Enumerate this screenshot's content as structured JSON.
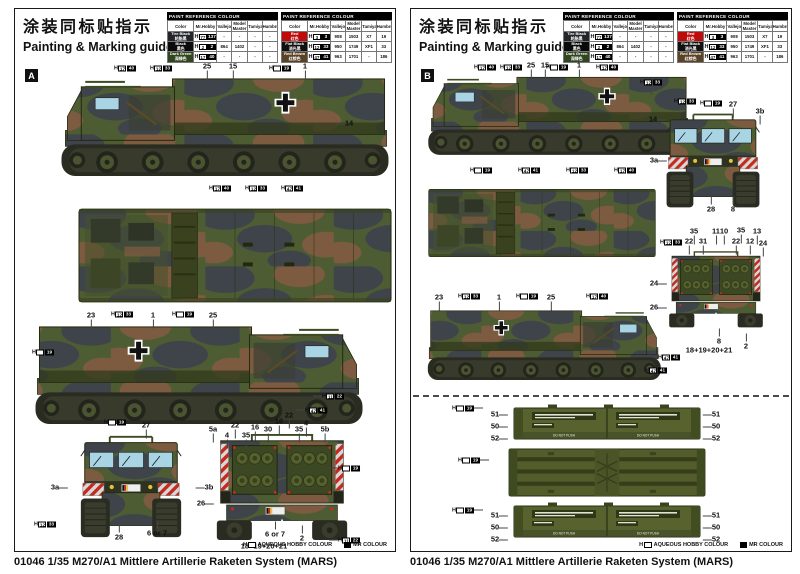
{
  "header": {
    "title_cn": "涂装同标贴指示",
    "title_en": "Painting & Marking guide"
  },
  "paint_table_title": "PAINT REFERENCE COLOUR",
  "paint_columns": [
    "Color",
    "Mr.Hobby",
    "Vallejo",
    "Model Master",
    "Tamiya",
    "Humbrol"
  ],
  "paint_tables": [
    {
      "rows": [
        {
          "name": "Tire Black",
          "name_cn": "轮胎黑",
          "swatch": "#23252a",
          "fg": "#ffffff",
          "chip": {
            "h": "77",
            "c": "137"
          },
          "vallejo": "-",
          "model_master": "-",
          "tamiya": "-",
          "humbrol": "-"
        },
        {
          "name": "Black",
          "name_cn": "黑色",
          "swatch": "#0a0a0a",
          "fg": "#ffffff",
          "chip": {
            "h": "2",
            "c": "2"
          },
          "vallejo": "864",
          "model_master": "1402",
          "tamiya": "-",
          "humbrol": "-"
        },
        {
          "name": "Dark Green",
          "name_cn": "深绿色",
          "swatch": "#31451f",
          "fg": "#ffffff",
          "chip": {
            "h": "17",
            "c": "40"
          },
          "vallejo": "-",
          "model_master": "-",
          "tamiya": "-",
          "humbrol": "-"
        }
      ]
    },
    {
      "rows": [
        {
          "name": "Red",
          "name_cn": "红色",
          "swatch": "#c00a0a",
          "fg": "#ffffff",
          "chip": {
            "h": "3",
            "c": "3"
          },
          "vallejo": "908",
          "model_master": "1503",
          "tamiya": "X7",
          "humbrol": "19"
        },
        {
          "name": "Flat Black",
          "name_cn": "消光黑",
          "swatch": "#101010",
          "fg": "#ffffff",
          "chip": {
            "h": "12",
            "c": "33"
          },
          "vallejo": "950",
          "model_master": "1749",
          "tamiya": "XF1",
          "humbrol": "33"
        },
        {
          "name": "Red Brown",
          "name_cn": "红棕色",
          "swatch": "#5a4227",
          "fg": "#ffffff",
          "chip": {
            "h": "47",
            "c": "41"
          },
          "vallejo": "963",
          "model_master": "1701",
          "tamiya": "-",
          "humbrol": "186"
        }
      ]
    }
  ],
  "legend": {
    "h_label": "AQUEOUS HOBBY COLOUR",
    "mr_label": "MR COLOUR"
  },
  "caption": "01046 1/35 M270/A1 Mittlere Artillerie Raketen System (MARS)",
  "pod_stencil": "DO NOT PUSH",
  "panels": [
    {
      "marker": "A",
      "callouts": [
        {
          "t": "25",
          "x": 192,
          "y": 9,
          "tk": "d"
        },
        {
          "t": "15",
          "x": 218,
          "y": 9,
          "tk": "d"
        },
        {
          "t": "1",
          "x": 290,
          "y": 9,
          "tk": "d"
        },
        {
          "chip": {
            "h": "17",
            "c": "40"
          },
          "x": 110,
          "y": 10
        },
        {
          "chip": {
            "h": "12",
            "c": "33"
          },
          "x": 146,
          "y": 10
        },
        {
          "chip": {
            "h": "",
            "c": "19"
          },
          "x": 265,
          "y": 10
        },
        {
          "t": "14",
          "x": 334,
          "y": 66,
          "tk": "l"
        },
        {
          "chip": {
            "h": "17",
            "c": "40"
          },
          "x": 205,
          "y": 130
        },
        {
          "chip": {
            "h": "12",
            "c": "33"
          },
          "x": 241,
          "y": 130
        },
        {
          "chip": {
            "h": "47",
            "c": "41"
          },
          "x": 277,
          "y": 130
        },
        {
          "t": "23",
          "x": 76,
          "y": 258,
          "tk": "d"
        },
        {
          "chip": {
            "h": "12",
            "c": "33"
          },
          "x": 107,
          "y": 256
        },
        {
          "t": "1",
          "x": 138,
          "y": 258,
          "tk": "d"
        },
        {
          "chip": {
            "h": "",
            "c": "19"
          },
          "x": 168,
          "y": 256
        },
        {
          "t": "25",
          "x": 198,
          "y": 258,
          "tk": "d"
        },
        {
          "chip": {
            "h": "",
            "c": "19"
          },
          "x": 28,
          "y": 294,
          "tk": "r"
        },
        {
          "chip": {
            "h": "11",
            "c": "22"
          },
          "x": 318,
          "y": 338,
          "tk": "l"
        },
        {
          "chip": {
            "h": "47",
            "c": "41"
          },
          "x": 301,
          "y": 352,
          "tk": "l"
        },
        {
          "chip": {
            "h": "",
            "c": "19"
          },
          "x": 100,
          "y": 364
        },
        {
          "t": "27",
          "x": 131,
          "y": 368,
          "tk": "d"
        },
        {
          "t": "3a",
          "x": 40,
          "y": 430,
          "tk": "r"
        },
        {
          "t": "3b",
          "x": 194,
          "y": 430,
          "tk": "l"
        },
        {
          "chip": {
            "h": "12",
            "c": "33"
          },
          "x": 30,
          "y": 466
        },
        {
          "t": "28",
          "x": 104,
          "y": 480,
          "tk": "u"
        },
        {
          "t": "6 or 7",
          "x": 142,
          "y": 476,
          "tk": "u"
        },
        {
          "t": "5a",
          "x": 198,
          "y": 372,
          "tk": "d"
        },
        {
          "t": "4",
          "x": 212,
          "y": 378,
          "tk": "d"
        },
        {
          "t": "22",
          "x": 220,
          "y": 368,
          "tk": "d"
        },
        {
          "t": "35",
          "x": 231,
          "y": 378,
          "tk": "d"
        },
        {
          "t": "16",
          "x": 240,
          "y": 370,
          "tk": "d"
        },
        {
          "t": "30",
          "x": 253,
          "y": 372,
          "tk": "d"
        },
        {
          "t": "16",
          "x": 264,
          "y": 364,
          "tk": "d"
        },
        {
          "t": "22",
          "x": 274,
          "y": 358,
          "tk": "d"
        },
        {
          "t": "35",
          "x": 284,
          "y": 372,
          "tk": "d"
        },
        {
          "t": "4",
          "x": 291,
          "y": 366,
          "tk": "d"
        },
        {
          "t": "5b",
          "x": 310,
          "y": 372,
          "tk": "d"
        },
        {
          "t": "26",
          "x": 186,
          "y": 446,
          "tk": "r"
        },
        {
          "t": "6 or 7",
          "x": 260,
          "y": 477,
          "tk": "u"
        },
        {
          "t": "2",
          "x": 287,
          "y": 481,
          "tk": "u"
        },
        {
          "t": "18+19+20+21",
          "x": 249,
          "y": 489
        },
        {
          "chip": {
            "h": "",
            "c": "19"
          },
          "x": 334,
          "y": 410,
          "tk": "l"
        },
        {
          "chip": {
            "h": "11",
            "c": "22"
          },
          "x": 334,
          "y": 482,
          "tk": "l"
        }
      ]
    },
    {
      "marker": "B",
      "callouts": [
        {
          "t": "25",
          "x": 120,
          "y": 8,
          "tk": "d"
        },
        {
          "t": "15",
          "x": 134,
          "y": 8,
          "tk": "d"
        },
        {
          "t": "1",
          "x": 168,
          "y": 8,
          "tk": "d"
        },
        {
          "chip": {
            "h": "17",
            "c": "40"
          },
          "x": 74,
          "y": 9
        },
        {
          "chip": {
            "h": "12",
            "c": "33"
          },
          "x": 100,
          "y": 9
        },
        {
          "chip": {
            "h": "",
            "c": "19"
          },
          "x": 146,
          "y": 9
        },
        {
          "chip": {
            "h": "17",
            "c": "40"
          },
          "x": 196,
          "y": 9
        },
        {
          "t": "14",
          "x": 242,
          "y": 62,
          "tk": "r"
        },
        {
          "chip": {
            "h": "",
            "c": "19"
          },
          "x": 70,
          "y": 112
        },
        {
          "chip": {
            "h": "47",
            "c": "41"
          },
          "x": 118,
          "y": 112
        },
        {
          "chip": {
            "h": "12",
            "c": "33"
          },
          "x": 166,
          "y": 112
        },
        {
          "chip": {
            "h": "17",
            "c": "40"
          },
          "x": 214,
          "y": 112
        },
        {
          "chip": {
            "h": "12",
            "c": "33"
          },
          "x": 240,
          "y": 24,
          "tk": "d"
        },
        {
          "chip": {
            "h": "12",
            "c": "33"
          },
          "x": 274,
          "y": 43
        },
        {
          "chip": {
            "h": "",
            "c": "19"
          },
          "x": 300,
          "y": 45
        },
        {
          "t": "27",
          "x": 322,
          "y": 47,
          "tk": "d"
        },
        {
          "t": "3b",
          "x": 349,
          "y": 54,
          "tk": "d"
        },
        {
          "t": "3a",
          "x": 243,
          "y": 103,
          "tk": "r"
        },
        {
          "t": "28",
          "x": 300,
          "y": 152,
          "tk": "u"
        },
        {
          "t": "8",
          "x": 322,
          "y": 152,
          "tk": "u"
        },
        {
          "t": "23",
          "x": 28,
          "y": 240,
          "tk": "d"
        },
        {
          "chip": {
            "h": "12",
            "c": "33"
          },
          "x": 58,
          "y": 238
        },
        {
          "t": "1",
          "x": 88,
          "y": 240,
          "tk": "d"
        },
        {
          "chip": {
            "h": "",
            "c": "19"
          },
          "x": 116,
          "y": 238
        },
        {
          "t": "25",
          "x": 140,
          "y": 240,
          "tk": "d"
        },
        {
          "chip": {
            "h": "17",
            "c": "40"
          },
          "x": 186,
          "y": 238
        },
        {
          "t": "35",
          "x": 283,
          "y": 174,
          "tk": "d"
        },
        {
          "t": "11",
          "x": 305,
          "y": 174,
          "tk": "d"
        },
        {
          "t": "10",
          "x": 313,
          "y": 174,
          "tk": "d"
        },
        {
          "t": "35",
          "x": 330,
          "y": 173,
          "tk": "d"
        },
        {
          "t": "13",
          "x": 346,
          "y": 174,
          "tk": "d"
        },
        {
          "chip": {
            "h": "12",
            "c": "33"
          },
          "x": 260,
          "y": 184
        },
        {
          "t": "22",
          "x": 278,
          "y": 184,
          "tk": "d"
        },
        {
          "t": "31",
          "x": 292,
          "y": 184,
          "tk": "d"
        },
        {
          "t": "22",
          "x": 325,
          "y": 184,
          "tk": "d"
        },
        {
          "t": "12",
          "x": 339,
          "y": 184,
          "tk": "d"
        },
        {
          "t": "24",
          "x": 352,
          "y": 186,
          "tk": "d"
        },
        {
          "t": "24",
          "x": 243,
          "y": 226,
          "tk": "r"
        },
        {
          "t": "26",
          "x": 243,
          "y": 250,
          "tk": "r"
        },
        {
          "t": "8",
          "x": 308,
          "y": 284,
          "tk": "u"
        },
        {
          "t": "2",
          "x": 335,
          "y": 289,
          "tk": "u"
        },
        {
          "t": "18+19+20+21",
          "x": 298,
          "y": 293
        },
        {
          "chip": {
            "h": "47",
            "c": "41"
          },
          "x": 258,
          "y": 299
        },
        {
          "chip": {
            "h": "47",
            "c": "41"
          },
          "x": 245,
          "y": 312
        },
        {
          "chip": {
            "h": "",
            "c": "19"
          },
          "x": 52,
          "y": 350,
          "tk": "r"
        },
        {
          "t": "51",
          "x": 84,
          "y": 357,
          "tk": "r"
        },
        {
          "t": "50",
          "x": 84,
          "y": 369,
          "tk": "r"
        },
        {
          "t": "52",
          "x": 84,
          "y": 381,
          "tk": "r"
        },
        {
          "t": "51",
          "x": 305,
          "y": 357,
          "tk": "l"
        },
        {
          "t": "50",
          "x": 305,
          "y": 369,
          "tk": "l"
        },
        {
          "t": "52",
          "x": 305,
          "y": 381,
          "tk": "l"
        },
        {
          "chip": {
            "h": "",
            "c": "19"
          },
          "x": 58,
          "y": 402,
          "tk": "r"
        },
        {
          "chip": {
            "h": "",
            "c": "19"
          },
          "x": 52,
          "y": 452,
          "tk": "r"
        },
        {
          "t": "51",
          "x": 84,
          "y": 458,
          "tk": "r"
        },
        {
          "t": "50",
          "x": 84,
          "y": 470,
          "tk": "r"
        },
        {
          "t": "52",
          "x": 84,
          "y": 482,
          "tk": "r"
        },
        {
          "t": "51",
          "x": 305,
          "y": 458,
          "tk": "l"
        },
        {
          "t": "50",
          "x": 305,
          "y": 470,
          "tk": "l"
        },
        {
          "t": "52",
          "x": 305,
          "y": 482,
          "tk": "l"
        }
      ]
    }
  ]
}
